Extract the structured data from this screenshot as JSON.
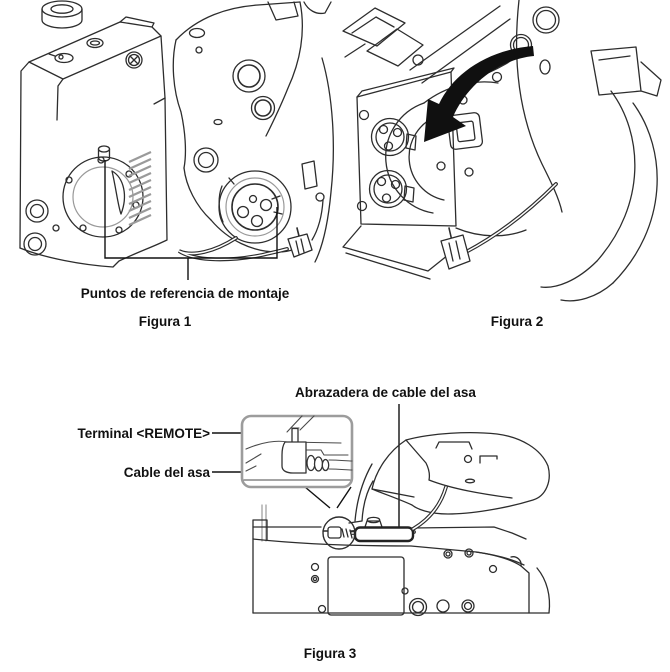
{
  "page": {
    "background": "#ffffff"
  },
  "colors": {
    "line": "#2d2d2d",
    "label_text": "#111111",
    "inset_border": "#9c9c9c",
    "arrow_fill": "#101010"
  },
  "figure1": {
    "caption": "Figura 1",
    "callout_mount_points": "Puntos de referencia de montaje"
  },
  "figure2": {
    "caption": "Figura 2"
  },
  "figure3": {
    "caption": "Figura 3",
    "callout_cable_clamp": "Abrazadera de cable del asa",
    "callout_remote_terminal": "Terminal <REMOTE>",
    "callout_handle_cable": "Cable del asa"
  }
}
